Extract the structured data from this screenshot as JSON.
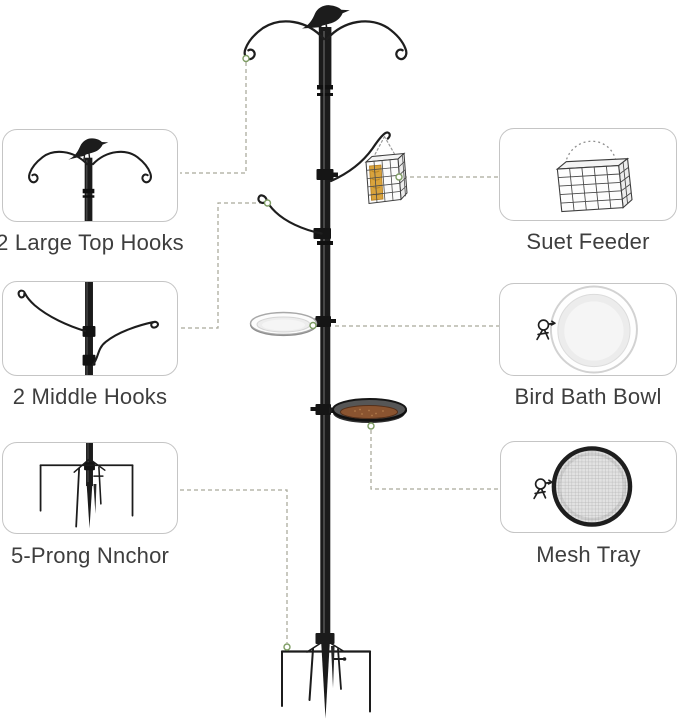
{
  "figure": {
    "type": "product-feature-diagram",
    "parts": [
      "bird-finial",
      "dual-top-hooks",
      "side-hook",
      "suet-cage",
      "bird-bath-bowl",
      "mesh-seed-tray",
      "five-prong-ground-anchor",
      "main-pole"
    ]
  },
  "callouts": [
    {
      "id": "top-hooks",
      "icon": "dual-top-hooks-with-bird-icon",
      "label": "2 Large Top Hooks",
      "side": "left"
    },
    {
      "id": "suet-feeder",
      "icon": "suet-cage-icon",
      "label": "Suet Feeder",
      "side": "right"
    },
    {
      "id": "middle-hooks",
      "icon": "dual-middle-hooks-icon",
      "label": "2 Middle Hooks",
      "side": "left"
    },
    {
      "id": "bird-bath",
      "icon": "bird-bath-bowl-icon",
      "label": "Bird Bath Bowl",
      "side": "right"
    },
    {
      "id": "five-prong-anchor",
      "icon": "five-prong-anchor-icon",
      "label": "5-Prong Nnchor",
      "side": "left"
    },
    {
      "id": "mesh-tray",
      "icon": "mesh-tray-icon",
      "label": "Mesh Tray",
      "side": "right"
    }
  ],
  "colors": {
    "background": "#ffffff",
    "metal": "#1c1c1c",
    "callout_border": "#c5c5c5",
    "label_text": "#3e3e3e",
    "connector_dash": "#a9a99b",
    "connector_ring": "#7d9c63",
    "suet": "#d9a33c",
    "seed_tray": "#8a5430"
  }
}
